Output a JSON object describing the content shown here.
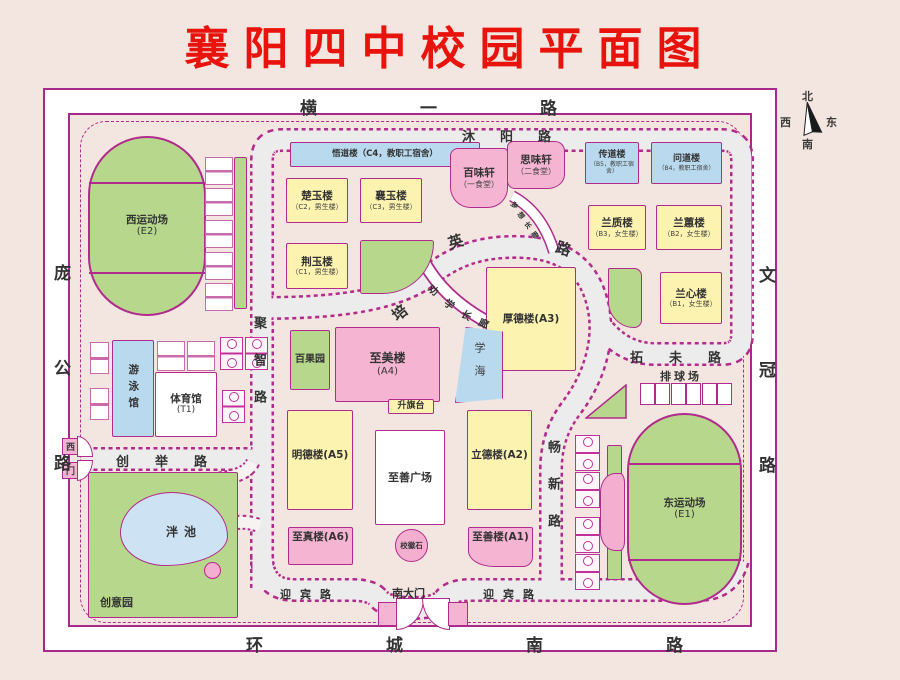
{
  "title": "襄阳四中校园平面图",
  "palette": {
    "title_red": "#e8130c",
    "border_magenta": "#b02b8c",
    "building_yellow": "#fcf3b0",
    "building_pink": "#f5b5d2",
    "building_blue": "#b9d9ee",
    "green_area": "#b7d88c",
    "pond_blue": "#cde2f2",
    "road_gray": "#ececec",
    "background": "#f3e5df"
  },
  "compass": {
    "north": "北",
    "south": "南",
    "east": "东",
    "west": "西"
  },
  "roads": {
    "hengyi": "横一路",
    "muyang": "沐阳路",
    "panggong": "庞公路",
    "wenguan": "文冠路",
    "huanchengnan": "环城南路",
    "yingbin_left": "迎宾路",
    "yingbin_right": "迎宾路",
    "chuangju": "创举路",
    "juzhi": "聚智路",
    "changxin": "畅新路",
    "tuowei": "拓未路",
    "peiying": "培英路",
    "quanxue": "劝学长廊",
    "mengxiang": "梦想长廊"
  },
  "gates": {
    "south": "南大门",
    "west_char1": "西",
    "west_char2": "门"
  },
  "buildings": {
    "wudao": {
      "name": "悟道楼（C4，教职工宿舍）"
    },
    "chuyu": {
      "name": "楚玉楼",
      "sub": "（C2，男生楼）"
    },
    "xiangyu": {
      "name": "襄玉楼",
      "sub": "（C3，男生楼）"
    },
    "jingyu": {
      "name": "荆玉楼",
      "sub": "（C1，男生楼）"
    },
    "baiweixuan": {
      "name": "百味轩",
      "sub": "（一食堂）"
    },
    "siweixuan": {
      "name": "思味轩",
      "sub": "（二食堂）"
    },
    "chuandao": {
      "name": "传道楼",
      "sub": "（B5，教职工宿舍）"
    },
    "wendao": {
      "name": "问道楼",
      "sub": "（B4，教职工宿舍）"
    },
    "lanzhi": {
      "name": "兰质楼",
      "sub": "（B3，女生楼）"
    },
    "lanhui": {
      "name": "兰蕙楼",
      "sub": "（B2，女生楼）"
    },
    "lanxin": {
      "name": "兰心楼",
      "sub": "（B1，女生楼）"
    },
    "houde": {
      "name": "厚德楼(A3)"
    },
    "zhimei": {
      "name": "至美楼",
      "sub": "(A4)"
    },
    "mingde": {
      "name": "明德楼(A5)"
    },
    "lide": {
      "name": "立德楼(A2)"
    },
    "zhizhen": {
      "name": "至真楼(A6)"
    },
    "zhishan": {
      "name": "至善楼(A1)"
    },
    "tiyuguan": {
      "name": "体育馆",
      "sub": "(T1)"
    },
    "youyongguan": {
      "name": "游泳馆"
    }
  },
  "places": {
    "west_stadium": {
      "name": "西运动场",
      "sub": "(E2)"
    },
    "east_stadium": {
      "name": "东运动场",
      "sub": "(E1)"
    },
    "baiguoyuan": "百果园",
    "xuehai": "学海",
    "shengqitai": "升旗台",
    "zhishan_square": "至善广场",
    "xiaohuishi": "校徽石",
    "paiqiuchang": "排球场",
    "panchi": "泮池",
    "chuangyiyuan": "创意园"
  }
}
